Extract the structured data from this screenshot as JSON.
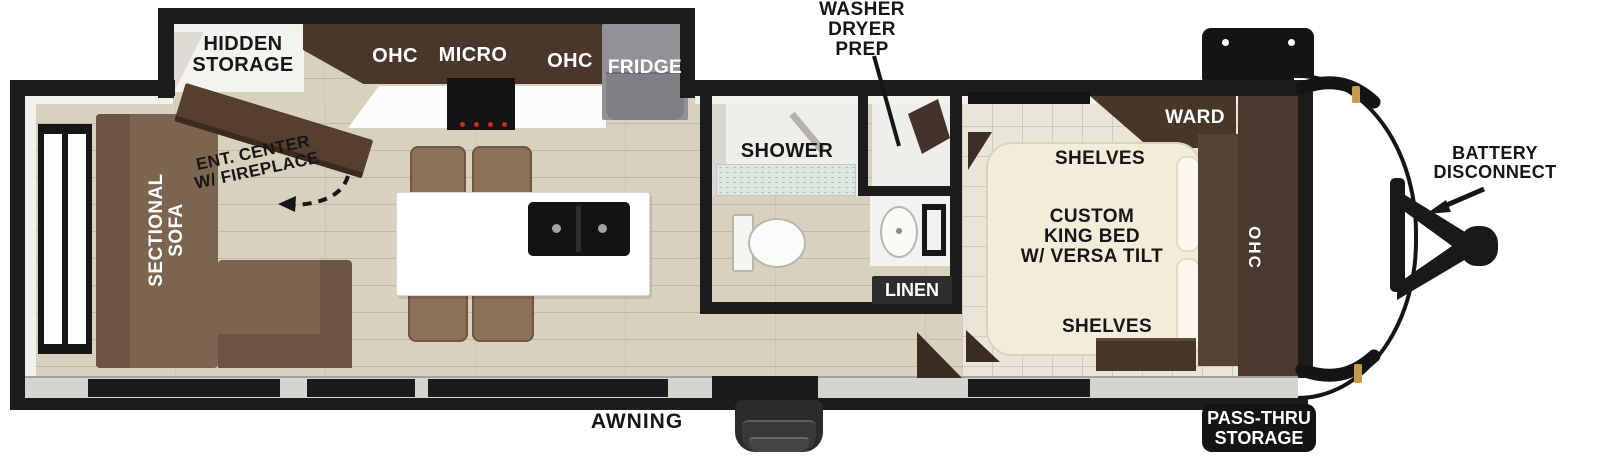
{
  "title": "Travel trailer floorplan",
  "colors": {
    "wall": "#1c1c1c",
    "floor": "#d7d1be",
    "bedroom_tile": "#e9e5d7",
    "cabinet_dark": "#4a382d",
    "sofa_brown": "#7b6550",
    "bed_cream": "#f2ecda",
    "fridge_gray": "#8f9093",
    "clearance_light_amber": "#c89a50"
  },
  "living": {
    "hidden_storage_label": "HIDDEN\nSTORAGE",
    "ent_center_label": "ENT. CENTER\nW/ FIREPLACE",
    "sofa_label": "SECTIONAL\nSOFA"
  },
  "kitchen": {
    "ohc_left_label": "OHC",
    "micro_label": "MICRO",
    "ohc_right_label": "OHC",
    "fridge_label": "FRIDGE"
  },
  "bath": {
    "shower_label": "SHOWER",
    "washer_dryer_label": "WASHER\nDRYER\nPREP",
    "linen_label": "LINEN"
  },
  "bedroom": {
    "ward_label": "WARD",
    "shelves_top_label": "SHELVES",
    "bed_label": "CUSTOM\nKING BED\nW/ VERSA TILT",
    "shelves_bottom_label": "SHELVES",
    "ohc_label": "OHC"
  },
  "exterior": {
    "battery_label": "BATTERY\nDISCONNECT",
    "awning_label": "AWNING",
    "pass_thru_label": "PASS-THRU\nSTORAGE"
  }
}
